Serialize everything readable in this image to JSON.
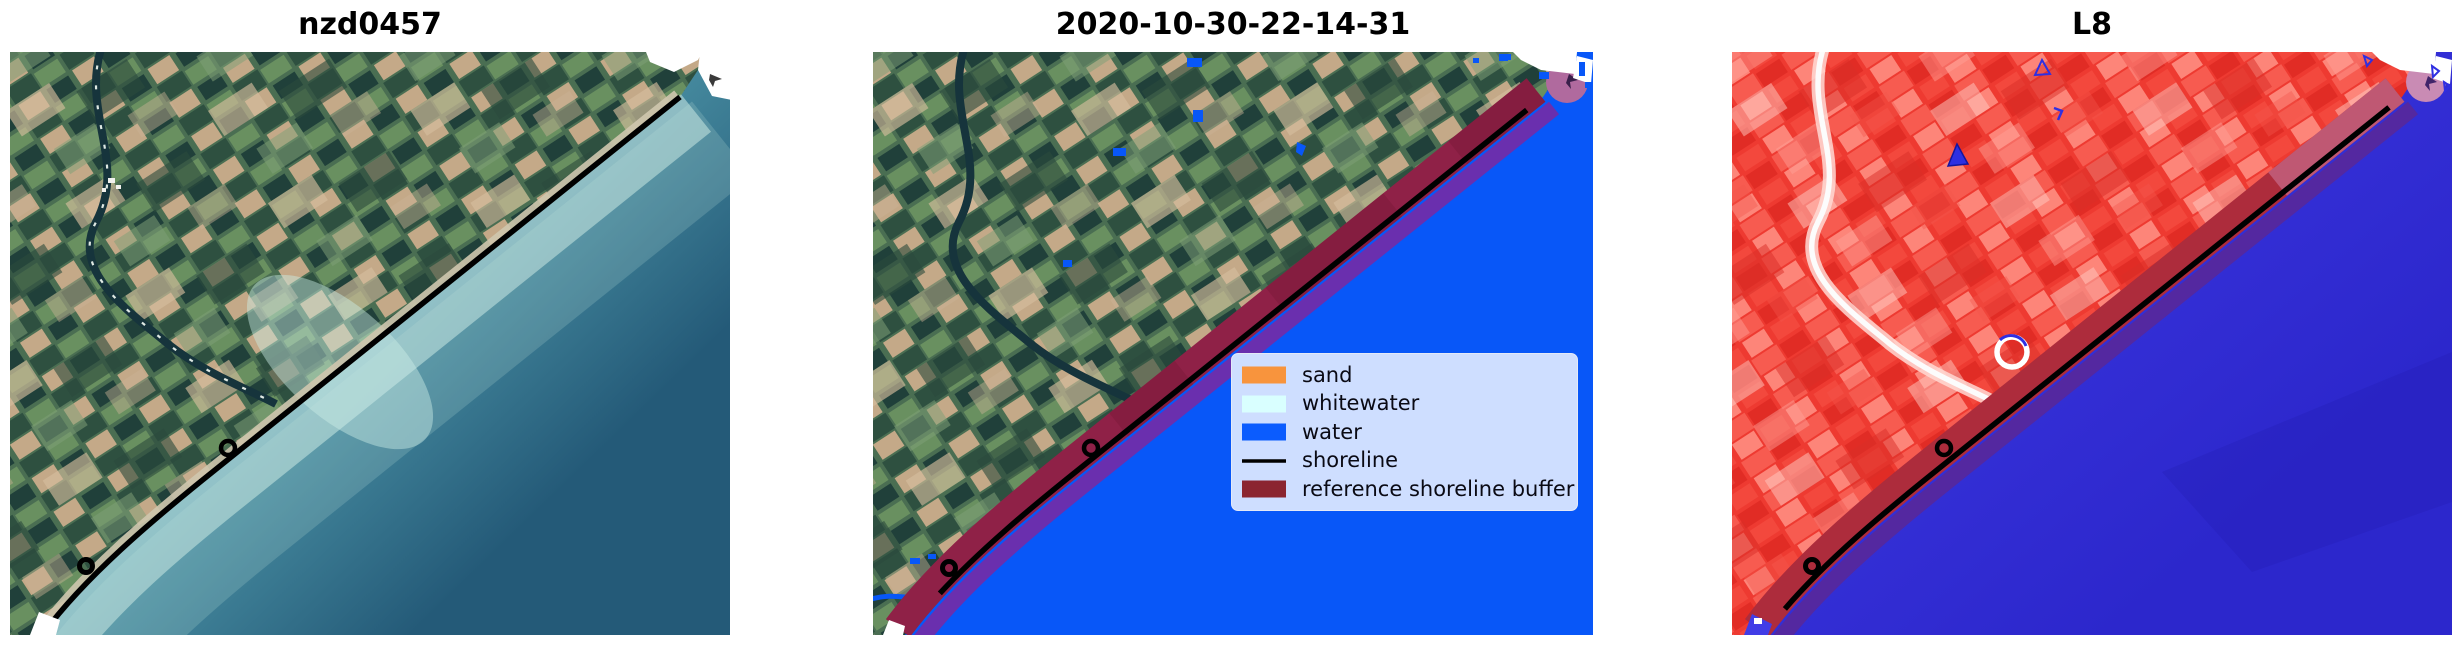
{
  "figure": {
    "background": "#ffffff"
  },
  "panels": [
    {
      "title": "nzd0457"
    },
    {
      "title": "2020-10-30-22-14-31"
    },
    {
      "title": "L8"
    }
  ],
  "legend": {
    "background": "#cedeff",
    "entries": [
      {
        "label": "sand",
        "color": "#f8943d",
        "kind": "patch"
      },
      {
        "label": "whitewater",
        "color": "#d9ffff",
        "kind": "patch"
      },
      {
        "label": "water",
        "color": "#0b5cfe",
        "kind": "patch"
      },
      {
        "label": "shoreline",
        "color": "#000000",
        "kind": "line"
      },
      {
        "label": "reference shoreline buffer",
        "color": "#8b2530",
        "kind": "patch"
      }
    ]
  },
  "colors": {
    "shoreline": "#000000",
    "p1_sea_shallow": "#c9ece3",
    "p1_sea_mid": "#4e96a8",
    "p1_sea_deep": "#245a78",
    "water_class": "#0857f8",
    "p2_buffer": "#8f2147",
    "p2_buffer_seaward": "#6a2fae",
    "p2_buffer_cap": "#b06a9e",
    "p3_land": "#ee3a31",
    "p3_sea": "#413ce6",
    "p3_sea_deep": "#2c27cc",
    "p3_buffer": "#ad2c3c",
    "p3_buffer_seaward": "#5428a0",
    "p3_buffer_cap": "#c98bb4",
    "p3_marker_blue": "#2f2fe2",
    "cloud_white": "#ffffff"
  }
}
